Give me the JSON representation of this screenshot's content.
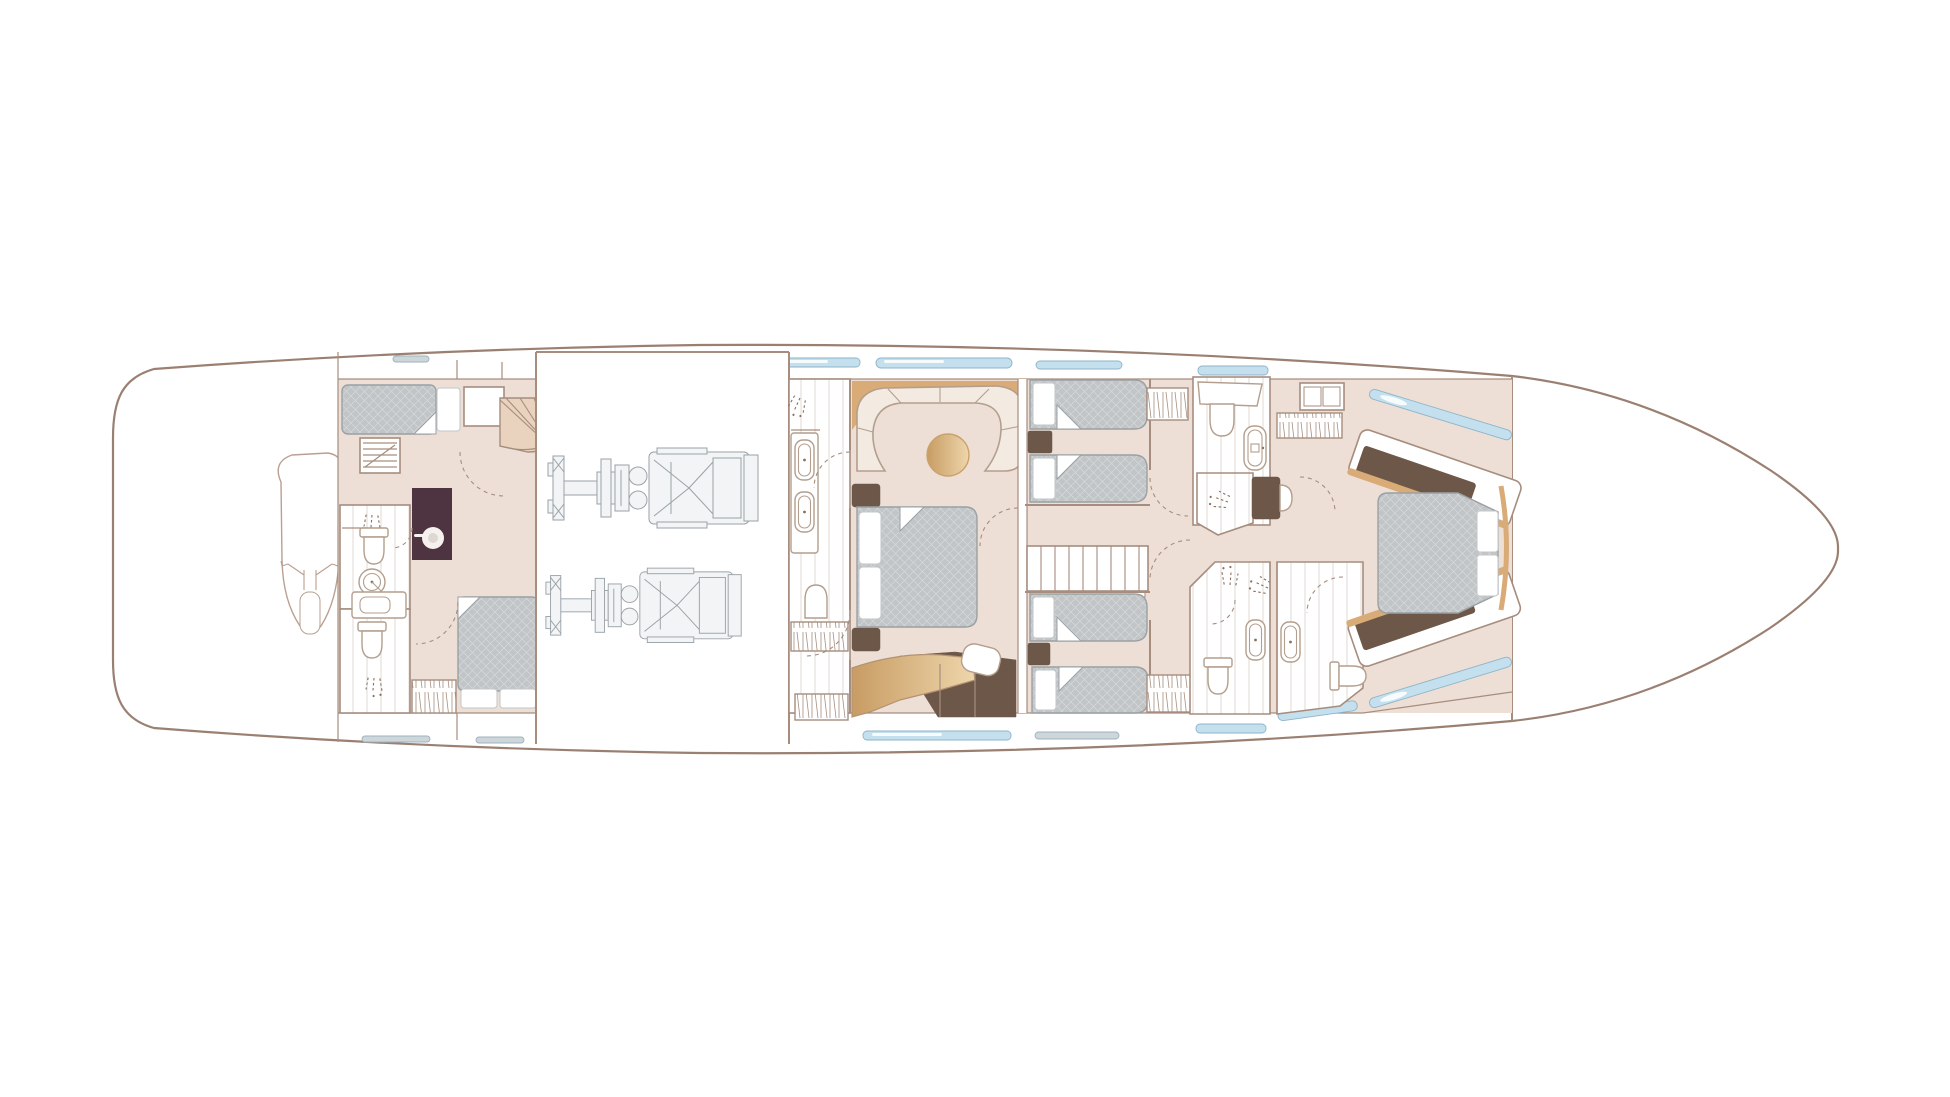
{
  "diagram": {
    "kind": "yacht-floor-plan",
    "deck": "lower-deck-accommodation",
    "orientation": "bow-right",
    "style": "architectural line drawing, no text labels"
  },
  "colors": {
    "bg": "#ffffff",
    "hull": "#9b8072",
    "wall": "#a68d7e",
    "floor": "#eddfd6",
    "dark-wood": "#6d5748",
    "plum": "#4e3440",
    "gold": "#d8ab77",
    "gold-light": "#eed6ab",
    "glass-blue": "#c4e0ee",
    "glass-edge": "#8fb5c8",
    "engine-line": "#9aa2a8",
    "engine-fill": "#f2f4f5",
    "stair": "#e9d2be",
    "plank-line": "#e2d9d3",
    "cream": "#f3ebe1"
  },
  "elements": {
    "cabins": [
      "crew-cabin-port",
      "crew-cabin-starboard",
      "master-stateroom",
      "twin-cabin-port",
      "twin-cabin-starboard",
      "forward-vip-cabin"
    ],
    "bathrooms": [
      "crew-bathroom-fwd",
      "crew-bathroom-aft",
      "master-bathroom",
      "forward-bathroom-port",
      "twin-bathroom",
      "vip-bathroom"
    ],
    "equipment": [
      "jet-ski-in-tender-garage",
      "main-engine-port",
      "main-engine-starboard",
      "washing-machine",
      "companionway-stairs",
      "crew-stairs"
    ],
    "furniture": [
      "curved-sofa",
      "round-table",
      "dressing-desk",
      "vanity-desk",
      "wardrobes",
      "bathtub",
      "showers",
      "toilets",
      "sinks",
      "beds"
    ],
    "counts": {
      "beds": 8,
      "engines": 2,
      "hull_window_strips": 13,
      "bow_ports": 2,
      "door_swings": 10,
      "shower_sprays": 7
    }
  }
}
